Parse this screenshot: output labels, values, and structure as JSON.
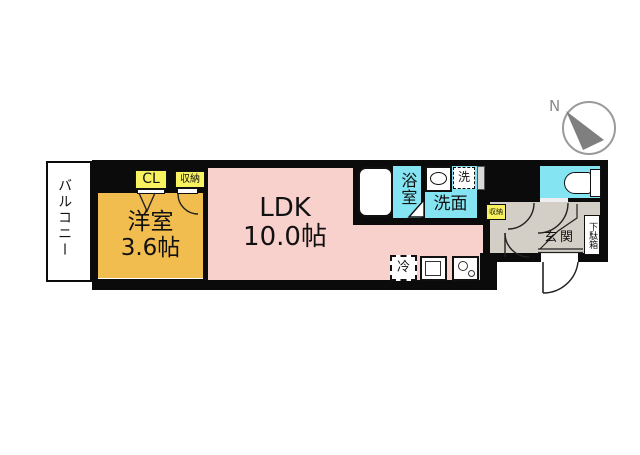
{
  "compass": {
    "north_label": "N"
  },
  "rooms": {
    "balcony": {
      "label": "バルコニー"
    },
    "western_room": {
      "label": "洋室",
      "size": "3.6帖"
    },
    "ldk": {
      "label": "LDK",
      "size": "10.0帖"
    },
    "bathroom": {
      "label": "浴室"
    },
    "washroom": {
      "label": "洗面"
    },
    "entrance": {
      "label": "玄関"
    }
  },
  "fixtures": {
    "closet": {
      "label": "CL"
    },
    "storage": {
      "label": "収納"
    },
    "hall_storage": {
      "label": "収納"
    },
    "washer": {
      "label": "洗"
    },
    "refrigerator": {
      "label": "冷"
    },
    "shoe_cabinet": {
      "label": "下駄箱"
    }
  },
  "colors": {
    "wall": "#0b0b0b",
    "room_western": "#F2BD4F",
    "room_ldk": "#F8D0CC",
    "room_wet": "#84E4F2",
    "room_hall": "#D3CFC6",
    "closet_yellow": "#F8F261",
    "compass_gray": "#8a8a8a"
  }
}
